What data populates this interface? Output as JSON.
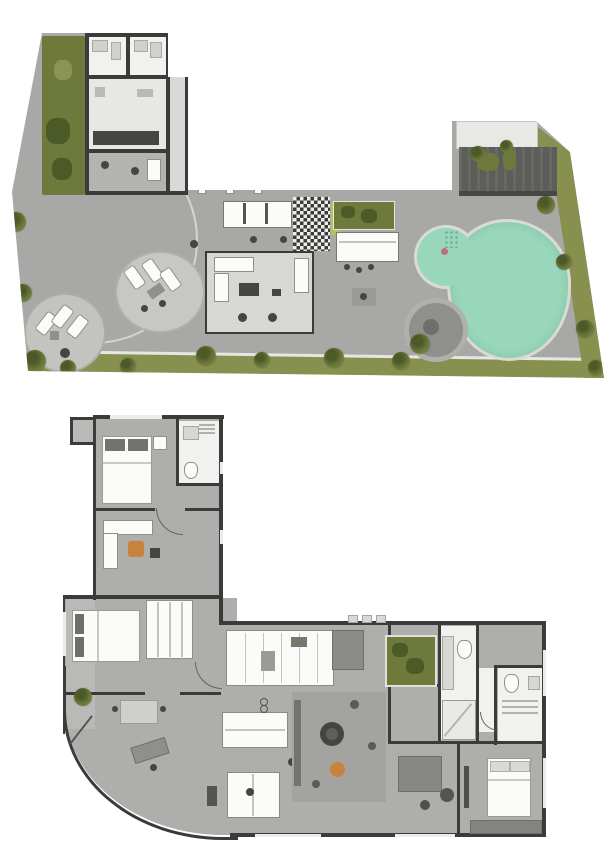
{
  "colors": {
    "background": "#ffffff",
    "deck": "#a8a8a6",
    "floor": "#aeaeac",
    "balcony": "#b9b9b7",
    "wall": "#3b3b39",
    "room": "#f1f1ef",
    "furniture-white": "#fbfbf9",
    "furniture-dark": "#454543",
    "lawn": "#87904e",
    "tree": "#6e7a3c",
    "tree-dark": "#4c5a28",
    "pool-water": "#98d7bb",
    "pool-rim": "#dadad6",
    "pergola": "#5d5d59",
    "accent-orange": "#c8823c",
    "accent-pink": "#c36b7e",
    "rug": "#a3a3a1",
    "spa": "#8f8f8b",
    "line-light": "#d4d4d0",
    "vine": "#b6c157"
  },
  "icons": {
    "tree-icon": {
      "shape": "textured-circle",
      "color": "#6e7a3c"
    },
    "pool": {
      "shape": "organic-blob",
      "color": "#98d7bb"
    },
    "spa": {
      "shape": "ring-circle",
      "color": "#8f8f8b"
    },
    "lawn-band": {
      "shape": "strip",
      "color": "#87904e"
    },
    "grill-grid": {
      "shape": "checkerboard",
      "colors": [
        "#3b3b39",
        "#ededeb"
      ]
    },
    "bed": {
      "shape": "rect-with-pillows",
      "color": "#fbfbf9"
    },
    "dining-table": {
      "shape": "circle",
      "color": "#454543"
    },
    "accent-chair": {
      "shape": "circle",
      "color": "#c8823c"
    }
  }
}
